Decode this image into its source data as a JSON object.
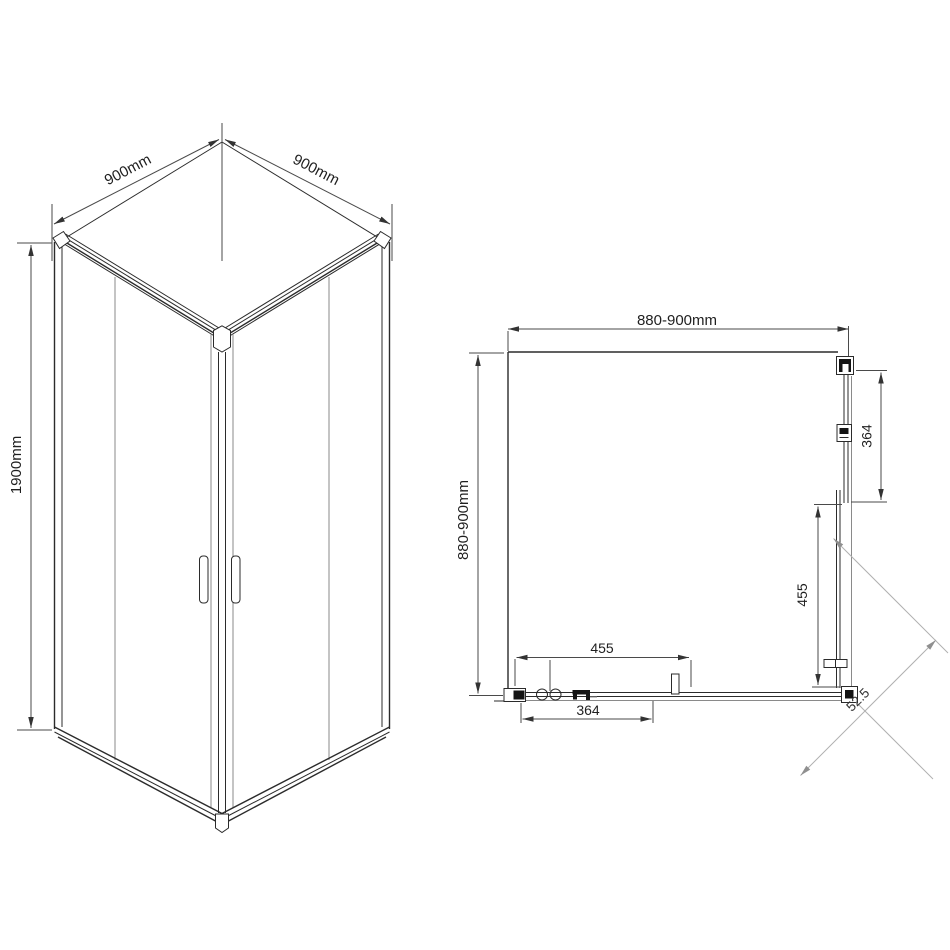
{
  "drawing": {
    "type": "shower enclosure technical drawing",
    "background_color": "#ffffff",
    "line_color": "#2b2b2b",
    "dimension_line_color": "#4a4a4a",
    "diagonal_guide_color": "#b0b0b0"
  },
  "isometric_view": {
    "description": "corner shower cabin, two sliding doors, isometric view",
    "labels": {
      "top_left_width": "900mm",
      "top_right_width": "900mm",
      "height": "1900mm"
    }
  },
  "plan_view": {
    "description": "top view of enclosure with adjustment ranges",
    "labels": {
      "top_width": "880-900mm",
      "left_depth": "880-900mm",
      "right_fixed_panel": "364",
      "right_sliding_door": "455",
      "bottom_sliding_door": "455",
      "bottom_fixed_panel": "364",
      "corner_entry_diagonal": "52.5"
    }
  }
}
